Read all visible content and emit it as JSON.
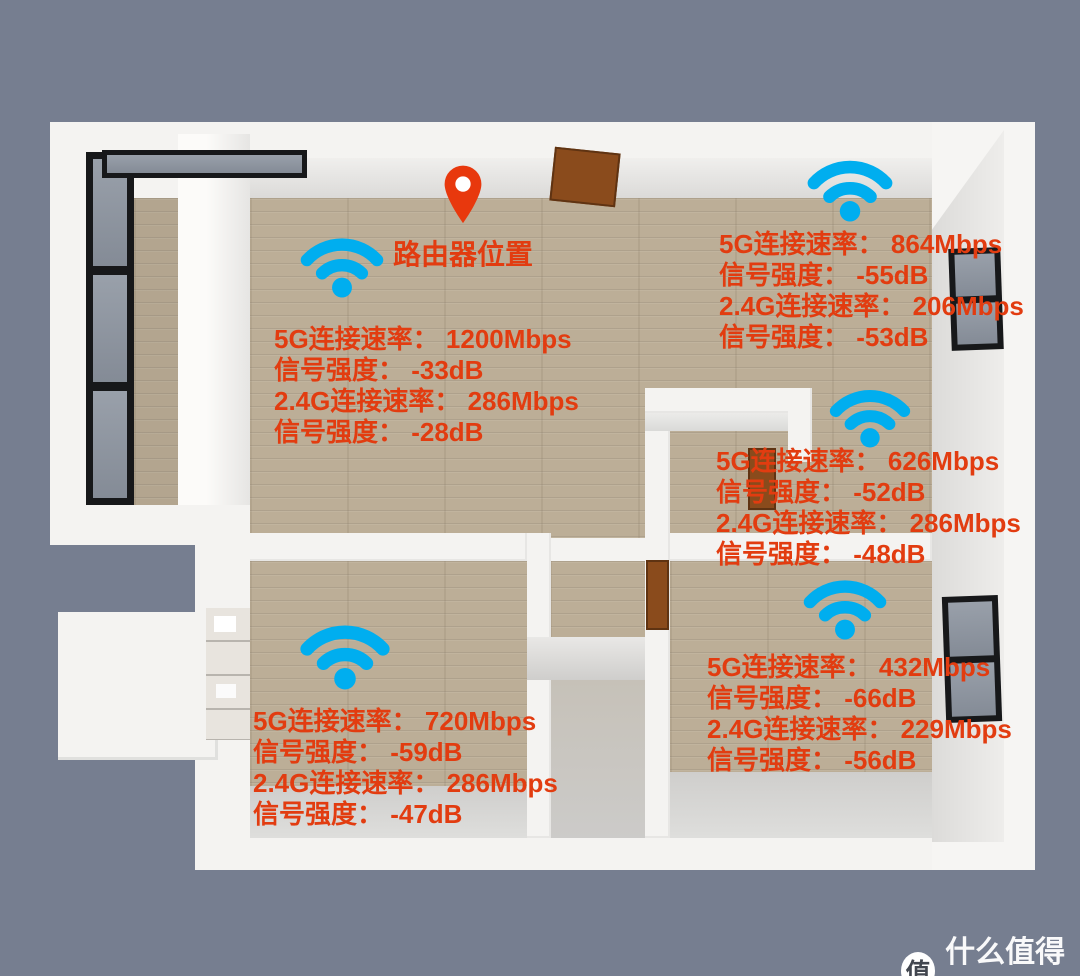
{
  "colors": {
    "background": "#767e90",
    "annotation": "#e23c10",
    "wifi_icon": "#00aeef",
    "router_pin": "#e8380d",
    "floor_wood": "#bcae97"
  },
  "router": {
    "label": "路由器位置"
  },
  "measurements": [
    {
      "location": "living-room",
      "lines": [
        "5G连接速率： 1200Mbps",
        "信号强度： -33dB",
        "2.4G连接速率： 286Mbps",
        "信号强度： -28dB"
      ]
    },
    {
      "location": "top-right-room",
      "lines": [
        "5G连接速率： 864Mbps",
        "信号强度： -55dB",
        "2.4G连接速率： 206Mbps",
        "信号强度： -53dB"
      ]
    },
    {
      "location": "middle-right-room",
      "lines": [
        "5G连接速率： 626Mbps",
        "信号强度： -52dB",
        "2.4G连接速率： 286Mbps",
        "信号强度： -48dB"
      ]
    },
    {
      "location": "bottom-right-room",
      "lines": [
        "5G连接速率： 432Mbps",
        "信号强度： -66dB",
        "2.4G连接速率： 229Mbps",
        "信号强度： -56dB"
      ]
    },
    {
      "location": "bottom-left-room",
      "lines": [
        "5G连接速率： 720Mbps",
        "信号强度： -59dB",
        "2.4G连接速率： 286Mbps",
        "信号强度： -47dB"
      ]
    }
  ],
  "watermark": {
    "badge": "值",
    "name": "什么值得买"
  }
}
